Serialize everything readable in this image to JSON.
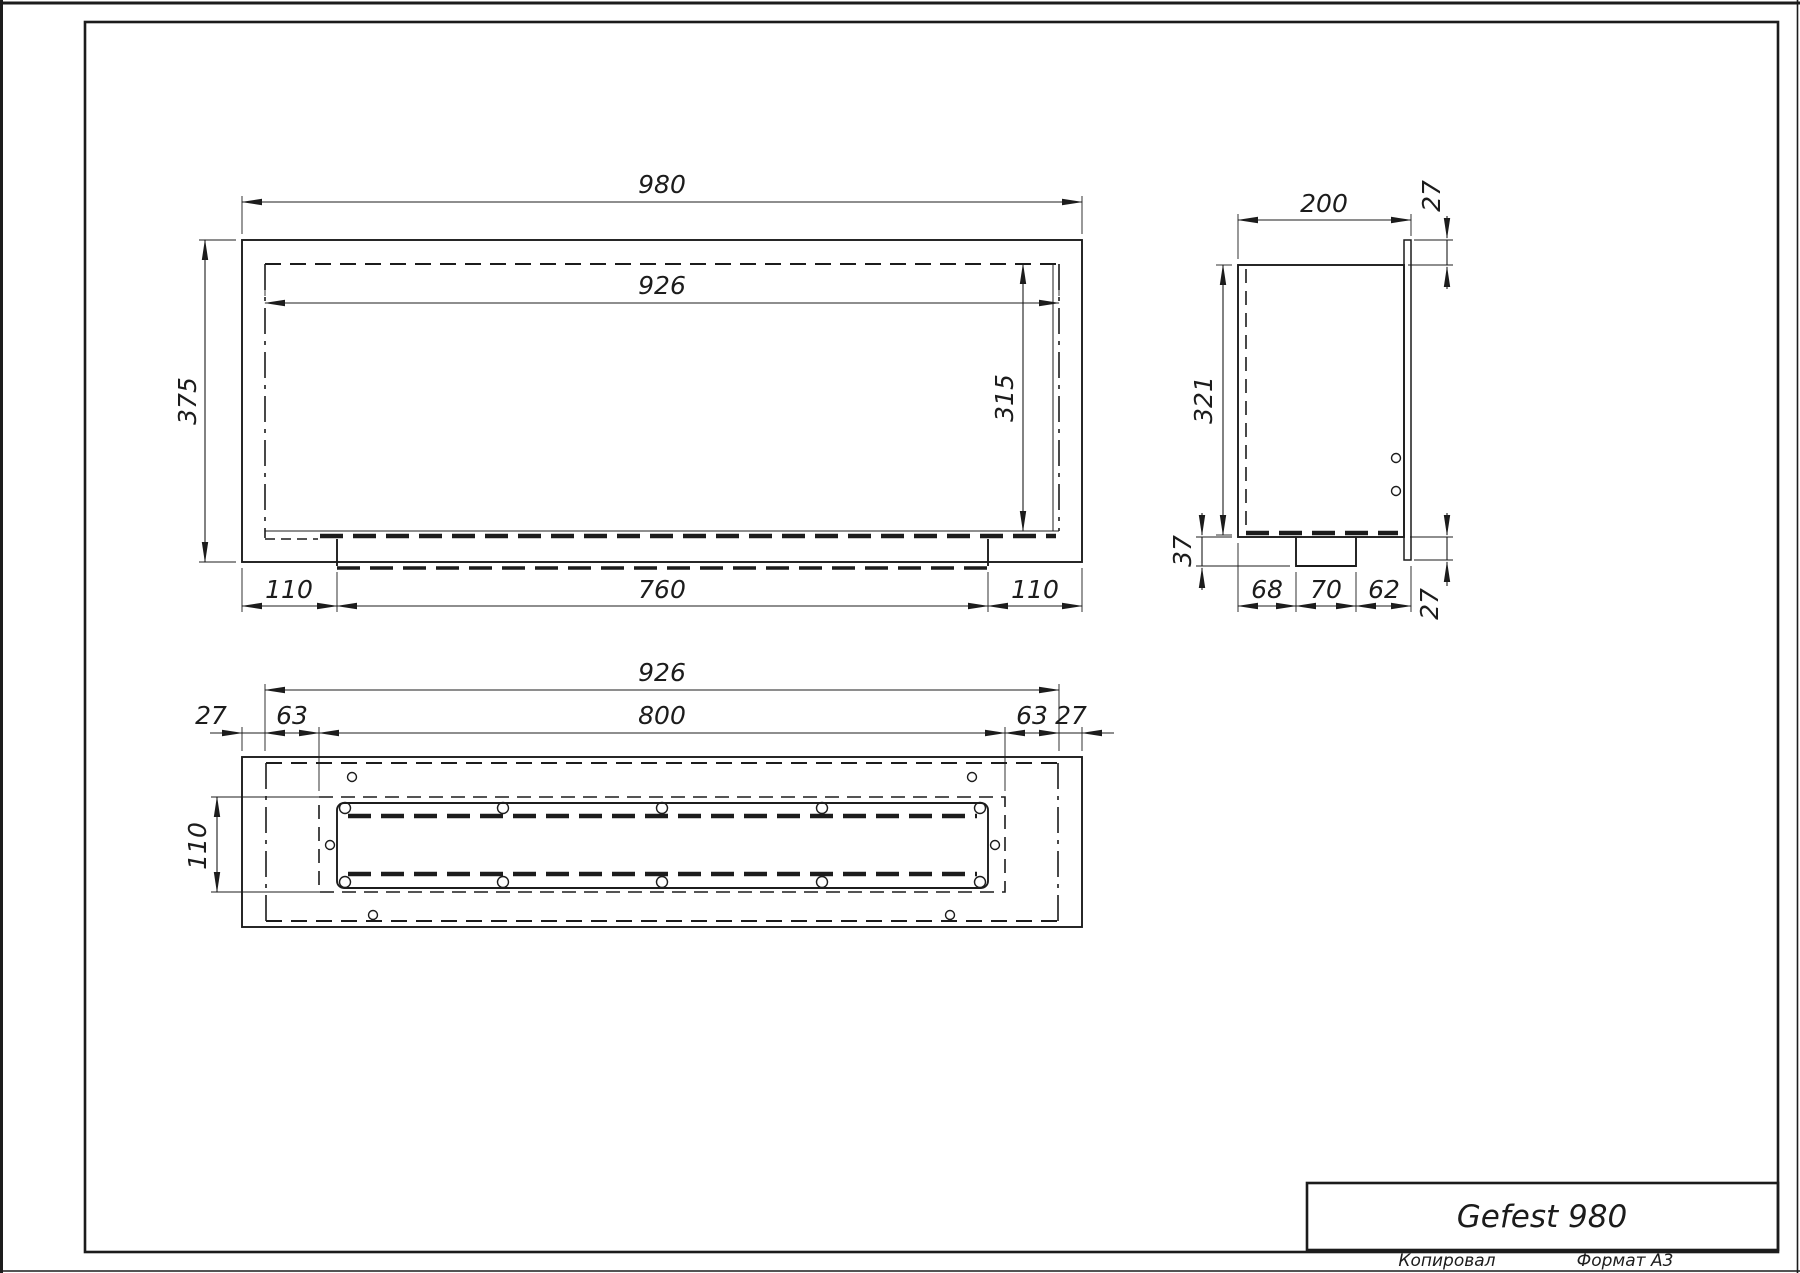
{
  "drawing": {
    "title": "Gefest 980",
    "footer": {
      "copied": "Копировал",
      "format": "Формат А3"
    },
    "front_view": {
      "outer_width": "980",
      "inner_width": "926",
      "outer_height": "375",
      "inner_height": "315",
      "bottom_left_offset": "110",
      "tray_width": "760",
      "bottom_right_offset": "110"
    },
    "side_view": {
      "depth": "200",
      "top_flange": "27",
      "inner_height": "321",
      "tray_depth": "37",
      "bottom_left": "68",
      "bottom_tray": "70",
      "bottom_right": "62",
      "bottom_flange": "27"
    },
    "bottom_view": {
      "inner_width": "926",
      "slot_length": "800",
      "wall_left": "27",
      "offset_left": "63",
      "offset_right": "63",
      "wall_right": "27",
      "slot_width": "110"
    }
  },
  "colors": {
    "line": "#1c1c1c",
    "background": "#ffffff"
  }
}
